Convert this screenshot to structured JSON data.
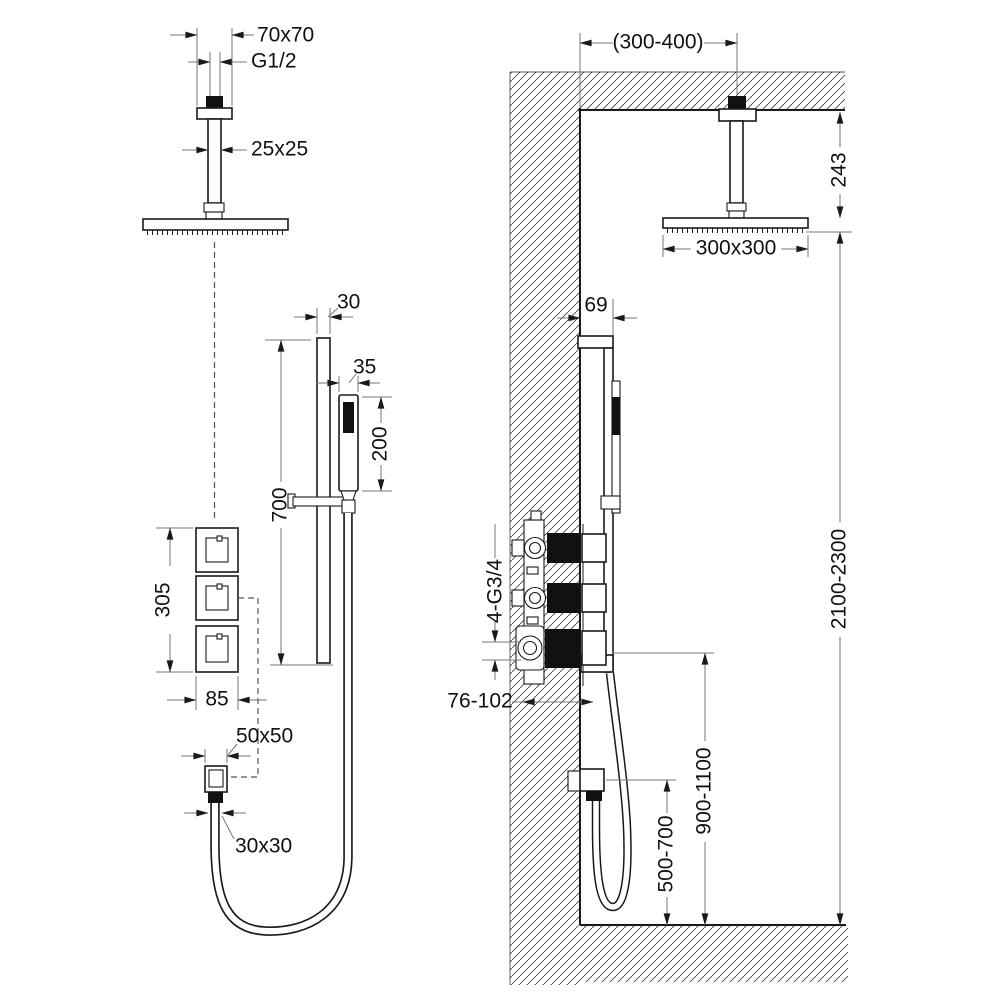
{
  "drawing": "shower-system-installation-dimensions",
  "labels": {
    "left": {
      "flange_size": "70x70",
      "thread_size": "G1/2",
      "arm_size": "25x25",
      "bar_width": "30",
      "handset_width": "35",
      "handset_length": "200",
      "bar_length": "700",
      "valves_span": "305",
      "valve_plate_width": "85",
      "outlet_plate_size": "50x50",
      "outlet_connector_size": "30x30"
    },
    "right": {
      "ceiling_offset": "(300-400)",
      "head_drop": "243",
      "head_size": "300x300",
      "bar_offset": "69",
      "connection_ports": "4-G3/4",
      "rough_in_depth": "76-102",
      "installation_height": "2100-2300",
      "valve_height": "900-1100",
      "outlet_height": "500-700"
    }
  },
  "colors": {
    "line": "#1a1a1a",
    "dimension": "#777777",
    "hatch": "#4a4a4a",
    "text": "#111111",
    "background": "#ffffff"
  }
}
